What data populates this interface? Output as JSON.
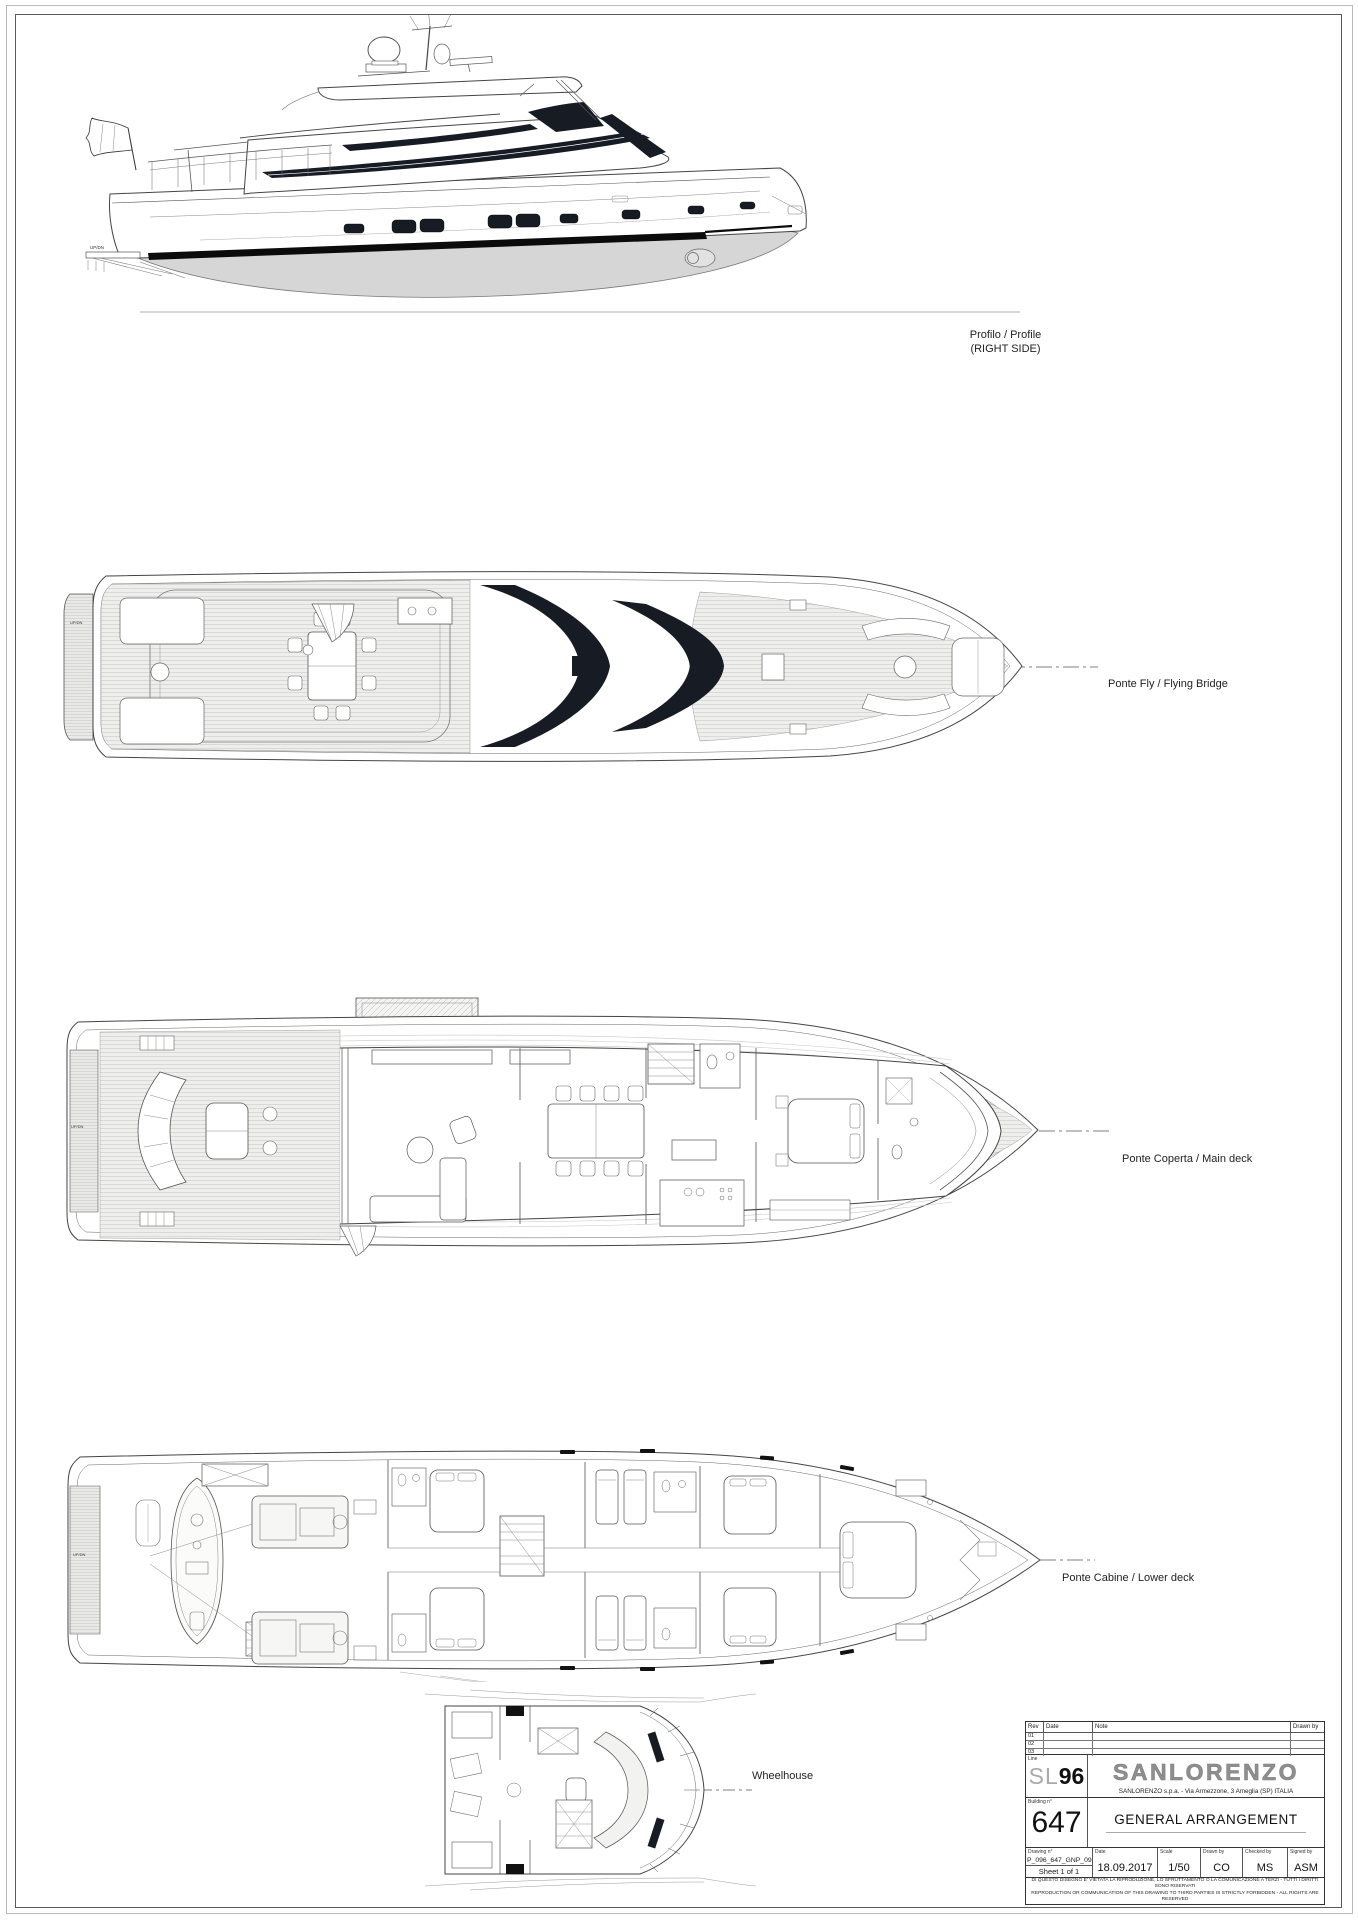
{
  "views": {
    "profile": {
      "label_line1": "Profilo / Profile",
      "label_line2": "(RIGHT SIDE)",
      "updn": "UP/DN"
    },
    "fly": {
      "label": "Ponte Fly / Flying Bridge",
      "updn": "UP/DN"
    },
    "main": {
      "label": "Ponte Coperta / Main deck",
      "updn": "UP/DN"
    },
    "lower": {
      "label": "Ponte Cabine / Lower deck",
      "updn": "UP/DN"
    },
    "wheelhouse": {
      "label": "Wheelhouse"
    }
  },
  "title_block": {
    "rev_table": {
      "headers": [
        "Rev",
        "Date",
        "Note",
        "Drawn by"
      ],
      "rows": [
        "01",
        "02",
        "03"
      ],
      "line_label": "Line"
    },
    "model": {
      "prefix": "SL",
      "number": "96"
    },
    "brand": {
      "logo": "SANLORENZO",
      "address": "SANLORENZO s.p.a. - Via Armezzone, 3 Ameglia (SP) ITALIA"
    },
    "building": {
      "label": "Building n°",
      "number": "647"
    },
    "drawing_title": "GENERAL ARRANGEMENT",
    "fields": {
      "drawing_no_label": "Drawing n°",
      "drawing_no": "P_096_647_GNP_09",
      "sheet": "Sheet 1 of 1",
      "date_label": "Date",
      "date": "18.09.2017",
      "scale_label": "Scale",
      "scale": "1/50",
      "drawn_label": "Drawn by",
      "drawn": "CO",
      "checked_label": "Checked by",
      "checked": "MS",
      "signed_label": "Signed by",
      "signed": "ASM"
    },
    "disclaimer_line1": "DI QUESTO DISEGNO E' VIETATA LA RIPRODUZIONE, LO SFRUTTAMENTO O LA COMUNICAZIONE A TERZI - TUTTI I DIRITTI SONO RISERVATI",
    "disclaimer_line2": "REPRODUCTION OR COMMUNICATION OF THIS DRAWING TO THIRD PARTIES IS STRICTLY FORBIDDEN - ALL RIGHTS ARE RESERVED"
  },
  "colors": {
    "glass": "#161b24",
    "line": "#444444",
    "underbody": "#d6d6d6"
  }
}
